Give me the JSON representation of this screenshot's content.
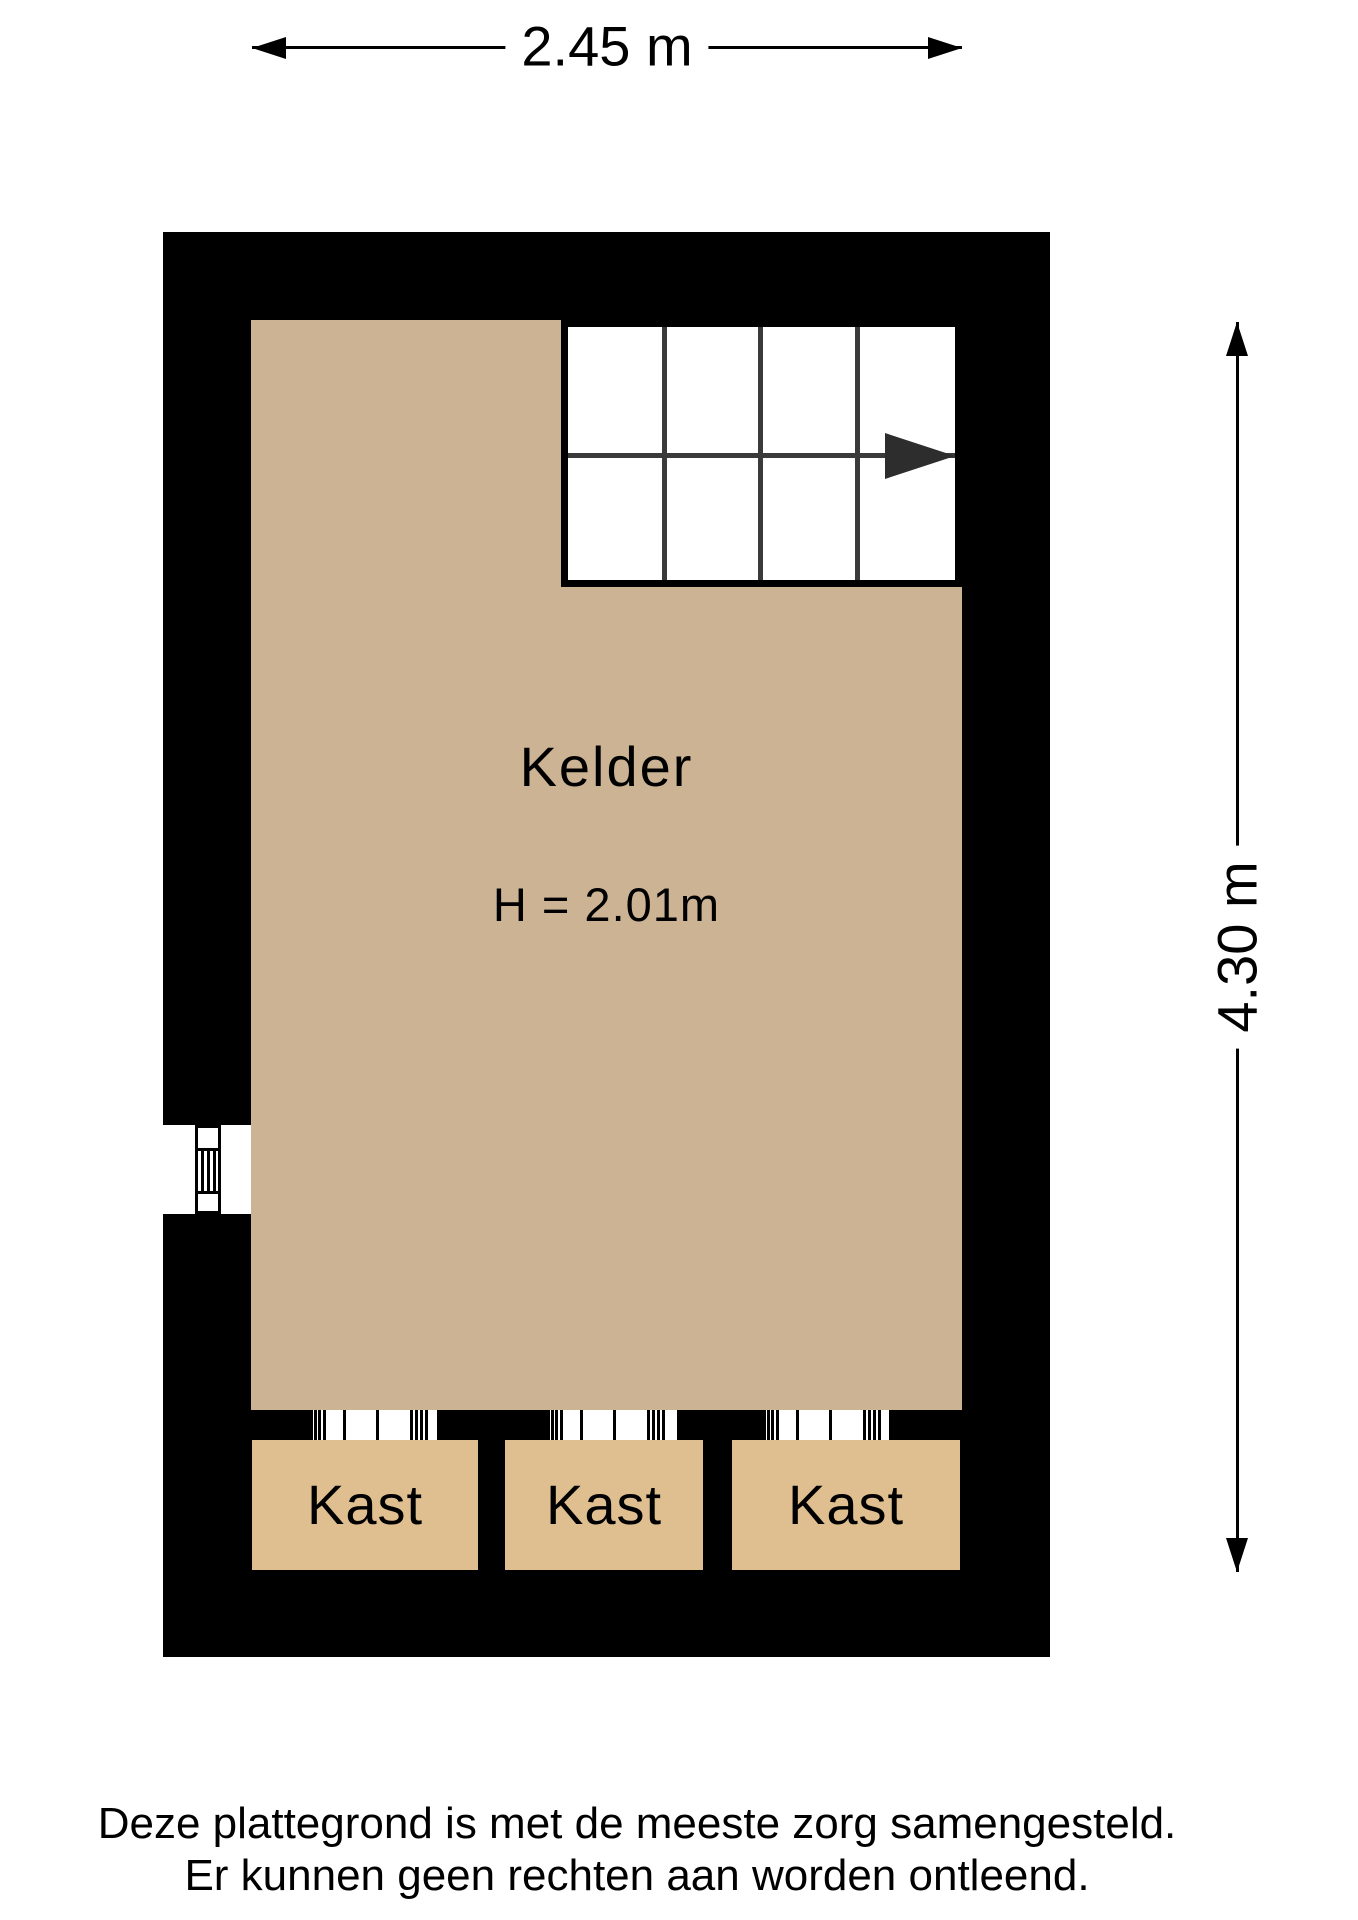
{
  "room": {
    "name": "Kelder",
    "height_note": "H = 2.01m"
  },
  "dimensions": {
    "width_label": "2.45 m",
    "height_label": "4.30 m"
  },
  "closets": [
    {
      "label": "Kast"
    },
    {
      "label": "Kast"
    },
    {
      "label": "Kast"
    }
  ],
  "stairs": {
    "columns": 4,
    "rows": 2,
    "direction": "right"
  },
  "footer": {
    "line1": "Deze plattegrond is met de meeste zorg samengesteld.",
    "line2": "Er kunnen geen rechten aan worden ontleend."
  },
  "colors": {
    "wall": "#000000",
    "floor": "#cbb394",
    "closet": "#dfbe90",
    "stairline": "#3a3a3a",
    "arrow": "#2d2d2d",
    "ink": "#000000",
    "paper": "#ffffff"
  }
}
